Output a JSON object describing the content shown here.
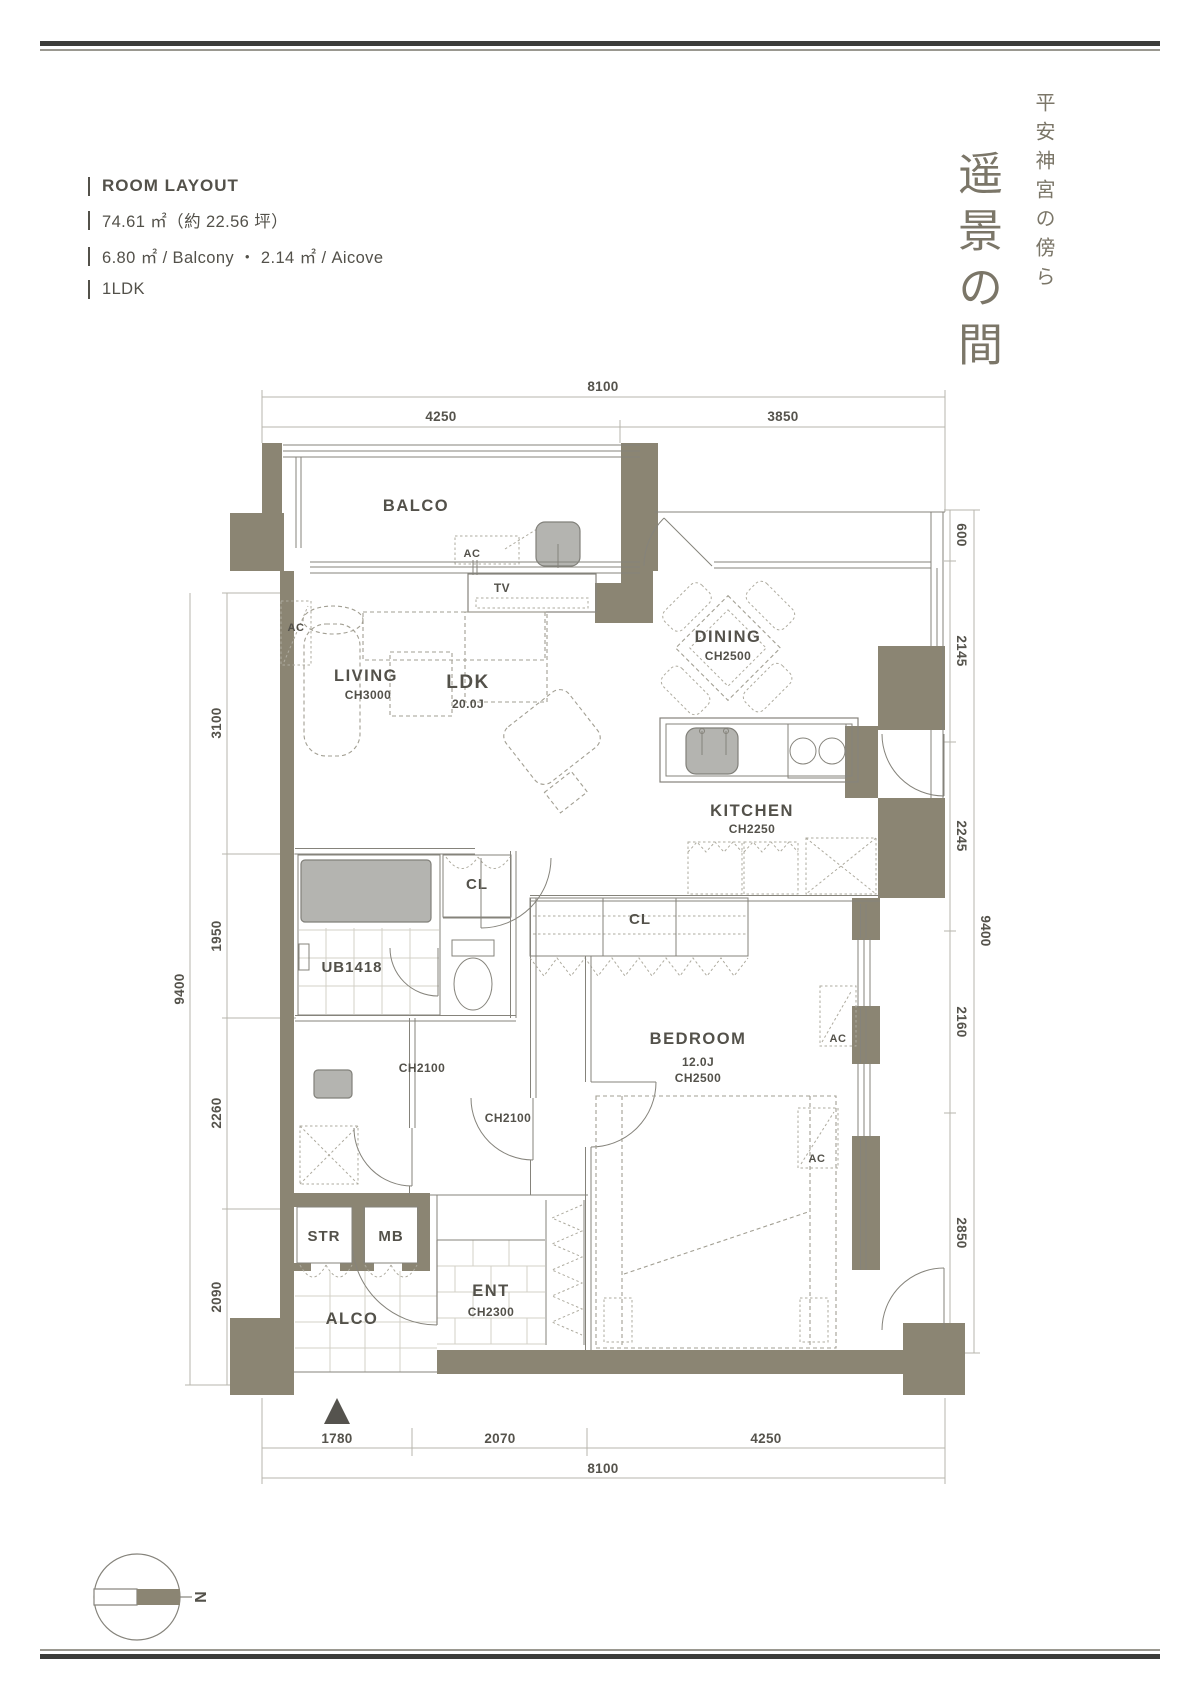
{
  "header": {
    "section_title": "ROOM LAYOUT",
    "area_line": "74.61 ㎡（約 22.56 坪）",
    "balcony_line": "6.80 ㎡ / Balcony ・ 2.14 ㎡ / Aicove",
    "type_line": "1LDK"
  },
  "unit_title": {
    "location_vertical": "平安神宮の傍ら",
    "name_vertical": "遥景の間"
  },
  "plan": {
    "rooms": {
      "balcony": "BALCO",
      "living": "LIVING",
      "living_ch": "CH3000",
      "ldk": "LDK",
      "ldk_size": "20.0J",
      "dining": "DINING",
      "dining_ch": "CH2500",
      "kitchen": "KITCHEN",
      "kitchen_ch": "CH2250",
      "closet": "CL",
      "unit_bath": "UB1418",
      "hall_ch": "CH2100",
      "bedroom": "BEDROOM",
      "bedroom_size": "12.0J",
      "bedroom_ch": "CH2500",
      "storage": "STR",
      "meter_box": "MB",
      "entrance": "ENT",
      "entrance_ch": "CH2300",
      "alcove": "ALCO"
    },
    "labels": {
      "tv": "TV",
      "ac": "AC",
      "north": "N"
    },
    "dims": {
      "top": {
        "total": "8100",
        "left": "4250",
        "right": "3850"
      },
      "bottom": {
        "segments": [
          "1780",
          "2070",
          "4250"
        ],
        "total": "8100"
      },
      "left": {
        "total": "9400",
        "segments": [
          "3100",
          "1950",
          "2260",
          "2090"
        ]
      },
      "right": {
        "total": "9400",
        "segments": [
          "600",
          "2145",
          "2245",
          "2160",
          "2850"
        ]
      }
    }
  },
  "colors": {
    "wall": "#8b8573",
    "ink": "#53514a",
    "calligraphy": "#7b7668",
    "fixture": "#b4b4b0"
  }
}
